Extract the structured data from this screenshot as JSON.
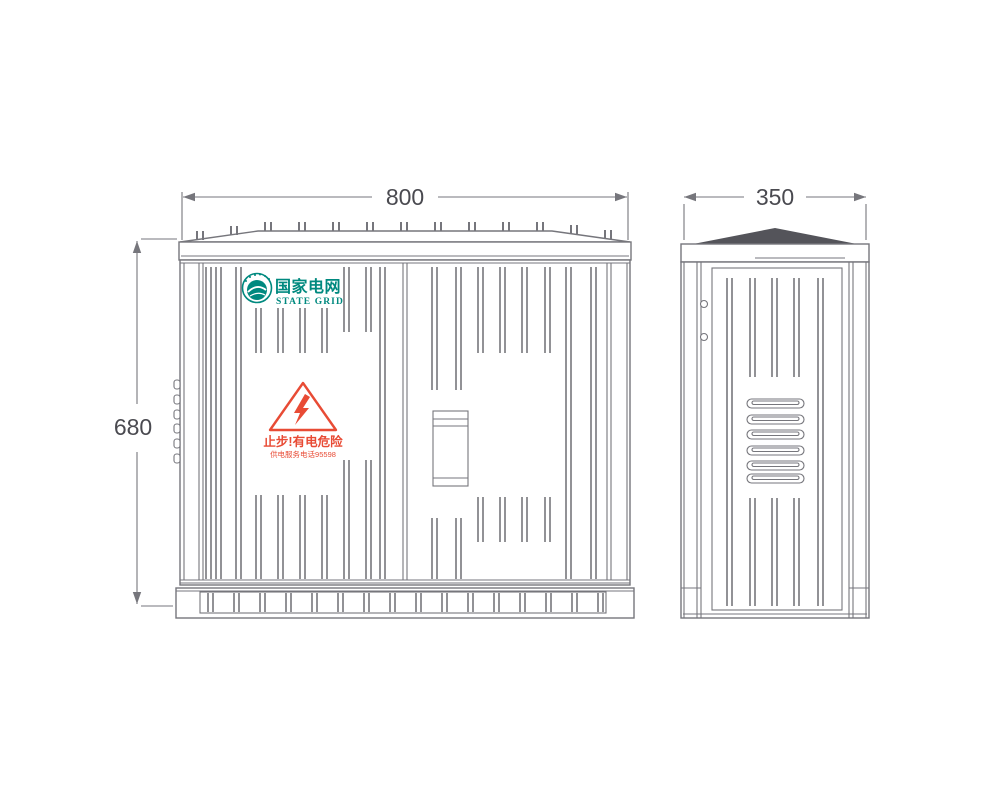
{
  "drawing": {
    "front_view": {
      "width_label": "800",
      "height_label": "680",
      "logo": {
        "name_cn": "国家电网",
        "name_en": "STATE GRID"
      },
      "warning": {
        "line1": "止步!有电危险",
        "line2": "供电服务电话95598"
      }
    },
    "side_view": {
      "width_label": "350"
    }
  },
  "colors": {
    "line_gray": "#76767c",
    "roof_dark": "#54545a",
    "brand_teal": "#00897f",
    "warning_red": "#e84b35",
    "dimension_text": "#4a4a50"
  }
}
